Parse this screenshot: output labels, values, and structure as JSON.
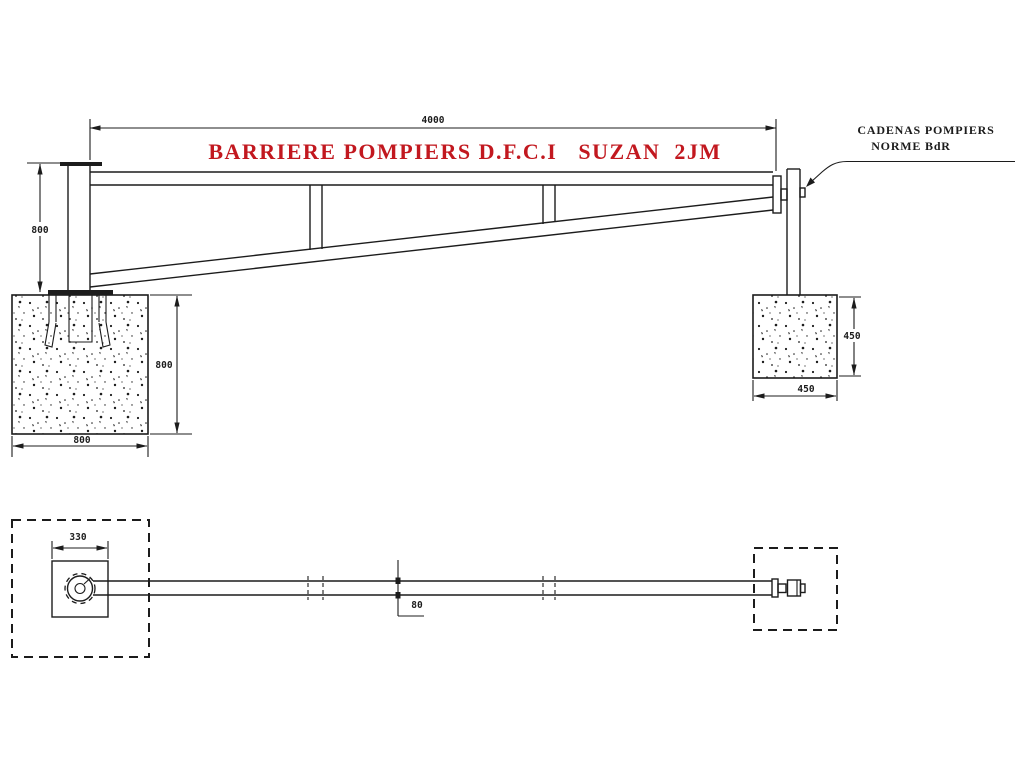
{
  "colors": {
    "title_red": "#c2181f",
    "ink": "#1c1c1c",
    "background": "#ffffff"
  },
  "title": {
    "text": "BARRIERE POMPIERS D.F.C.I   SUZAN  2JM"
  },
  "annotation": {
    "line1": "CADENAS POMPIERS",
    "line2": "NORME BdR"
  },
  "elevation_view": {
    "dim_overall_length": "4000",
    "dim_post_height": "800",
    "dim_left_foundation_height": "800",
    "dim_left_foundation_width": "800",
    "dim_right_foundation_height": "450",
    "dim_right_foundation_width": "450"
  },
  "plan_view": {
    "dim_baseplate_width": "330",
    "dim_arm_tube_width": "80"
  }
}
